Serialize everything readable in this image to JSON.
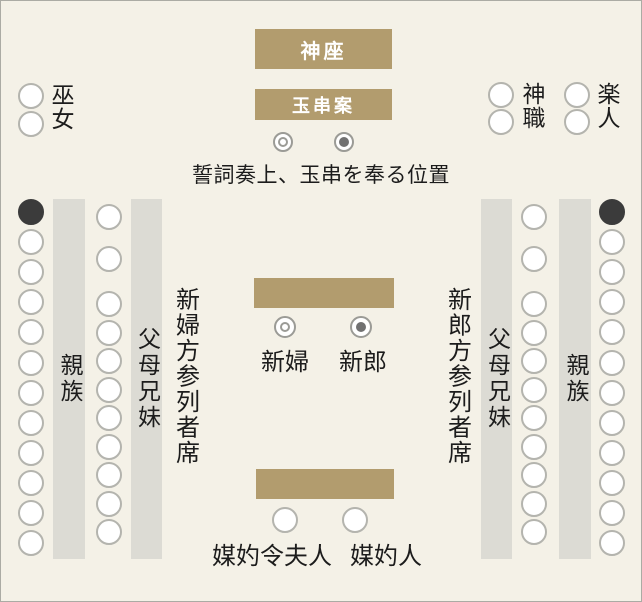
{
  "diagram_title": "shinto-wedding-seating-chart",
  "colors": {
    "background": "#f4f1e7",
    "border": "#ababa4",
    "table_tan": "#b29c6e",
    "bar_gray": "#dcdbd4",
    "seat_stroke": "#b4b4ae",
    "seat_black": "#3b3b3b",
    "marker_stroke": "#9b9b96",
    "marker_fill_gray": "#717171",
    "text": "#1c1c1c",
    "table_text": "#ffffff"
  },
  "altar": {
    "kamiza_label": "神座",
    "tamagushi_label": "玉串案"
  },
  "vow_caption": "誓詞奏上、玉串を奉る位置",
  "staff": {
    "miko_label": "巫女",
    "miko_seats": 2,
    "shinshoku_label": "神職",
    "shinshoku_seats": 2,
    "gakunin_label": "楽人",
    "gakunin_seats": 2
  },
  "couple": {
    "bride_label": "新婦",
    "groom_label": "新郎"
  },
  "matchmakers": {
    "wife_label": "媒妁令夫人",
    "matchmaker_label": "媒妁人",
    "seats": 2
  },
  "left_section": {
    "title": "新婦方参列者席",
    "relatives_label": "親族",
    "parents_siblings_label": "父母兄妹",
    "outer_seats": 12,
    "inner_seats_top": 2,
    "inner_seats_bottom": 9
  },
  "right_section": {
    "title": "新郎方参列者席",
    "relatives_label": "親族",
    "parents_siblings_label": "父母兄妹",
    "outer_seats": 12,
    "inner_seats_top": 2,
    "inner_seats_bottom": 9
  }
}
